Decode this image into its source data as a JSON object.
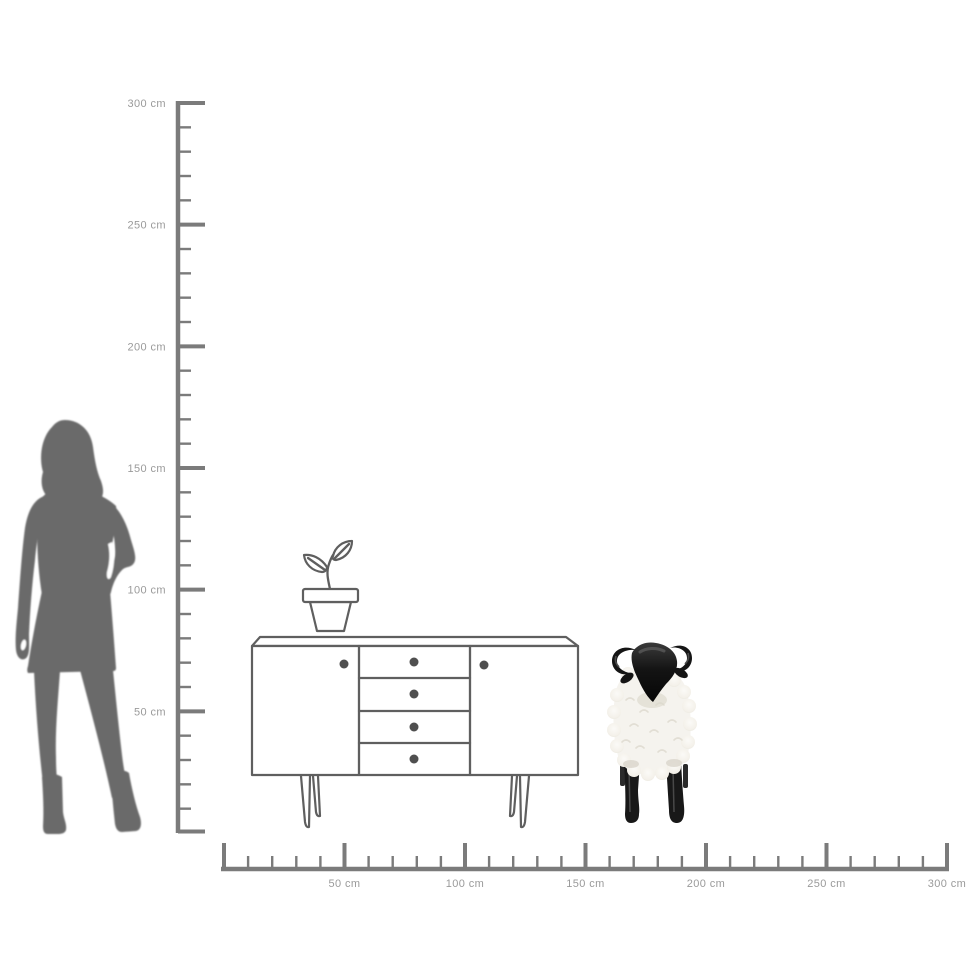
{
  "diagram": {
    "kind": "product-size-comparison",
    "rulers": {
      "unit": "cm",
      "range_cm": [
        0,
        300
      ],
      "major_tick_interval_cm": 50,
      "minor_tick_interval_cm": 10,
      "vertical": {
        "labels": [
          "300 cm",
          "250 cm",
          "200 cm",
          "150 cm",
          "100 cm",
          "50 cm"
        ]
      },
      "horizontal": {
        "labels": [
          "50 cm",
          "100 cm",
          "150 cm",
          "200 cm",
          "250 cm",
          "300 cm"
        ]
      }
    },
    "scene": {
      "figure": "woman-silhouette",
      "furniture": "sideboard-line-drawing",
      "plant": "potted-sprout-line-drawing",
      "product": "black-and-white-sheep-figurine"
    }
  },
  "colors": {
    "background": "#ffffff",
    "silhouette": "#6b6b6b",
    "lineart": "#5f5f5f",
    "knob": "#4f4f4f",
    "ruler": "#7b7b7b",
    "label": "#9a9a9a",
    "sheep_black": "#181818",
    "wool": "#f5f3ee"
  }
}
